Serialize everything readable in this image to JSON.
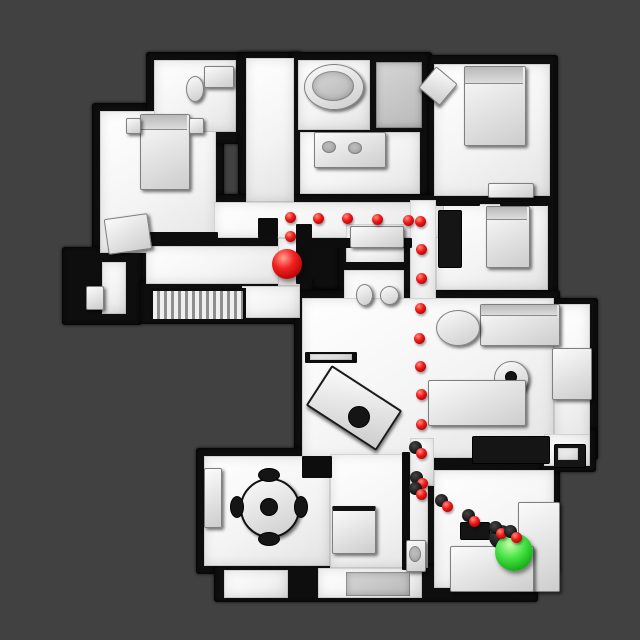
{
  "scene": {
    "type": "topdown-floorplan-navigation",
    "background_color": "#414141",
    "floor_color": "#f4f4f4",
    "wall_color": "#0e0e0e",
    "path_color": "#ee1b1b",
    "agent_color": "#f22222",
    "goal_color": "#42e142"
  },
  "path": {
    "dot_radius": 5.5,
    "shadow_radius": 6.5,
    "waypoints": [
      {
        "x": 290,
        "y": 236
      },
      {
        "x": 290,
        "y": 217
      },
      {
        "x": 318,
        "y": 218
      },
      {
        "x": 347,
        "y": 218
      },
      {
        "x": 377,
        "y": 219
      },
      {
        "x": 408,
        "y": 220
      },
      {
        "x": 420,
        "y": 221
      },
      {
        "x": 421,
        "y": 249
      },
      {
        "x": 421,
        "y": 278
      },
      {
        "x": 420,
        "y": 308
      },
      {
        "x": 419,
        "y": 338
      },
      {
        "x": 420,
        "y": 366
      },
      {
        "x": 421,
        "y": 394
      },
      {
        "x": 421,
        "y": 424
      },
      {
        "x": 421,
        "y": 453,
        "shadow": true
      },
      {
        "x": 422,
        "y": 483,
        "shadow": true
      },
      {
        "x": 421,
        "y": 494,
        "shadow": true
      },
      {
        "x": 447,
        "y": 506,
        "shadow": true
      },
      {
        "x": 474,
        "y": 521,
        "shadow": true
      },
      {
        "x": 501,
        "y": 533,
        "shadow": true
      },
      {
        "x": 516,
        "y": 537,
        "shadow": true
      }
    ],
    "agent": {
      "x": 287,
      "y": 264,
      "radius": 15
    },
    "goal": {
      "x": 514,
      "y": 552,
      "radius": 19,
      "shadow": true
    }
  }
}
